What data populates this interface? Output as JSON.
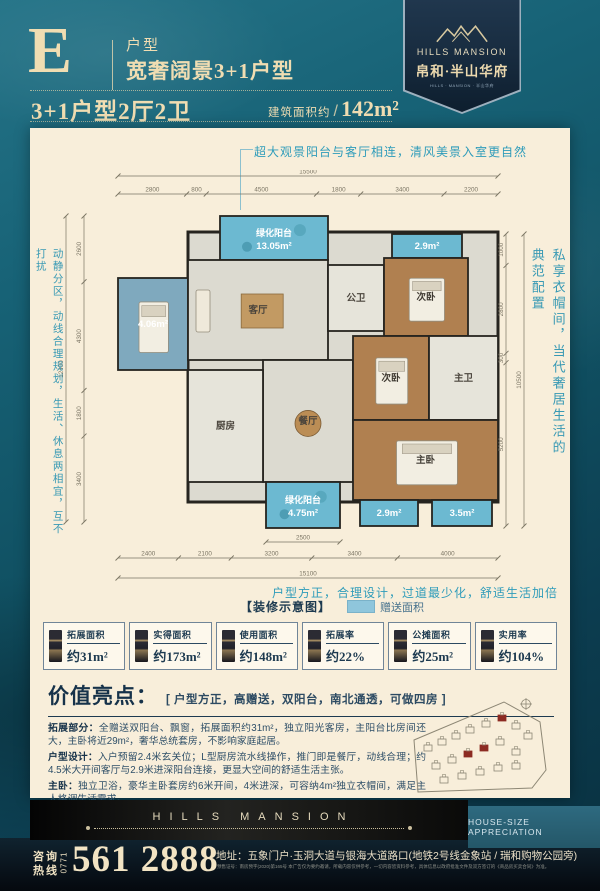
{
  "header": {
    "type_letter": "E",
    "type_label": "户型",
    "type_title": "宽奢阔景3+1户型",
    "spec": "3+1户型2厅2卫",
    "area_label": "建筑面积约",
    "area_divider": "/",
    "area_value": "142m²"
  },
  "logo": {
    "brand_en": "HILLS MANSION",
    "brand_cn": "帛和·半山华府",
    "tagline": "HILLS · MANSION · 半山华府"
  },
  "floorplan": {
    "annotation_top": "超大观景阳台与客厅相连，清风美景入室更自然",
    "annotation_bottom": "户型方正，合理设计，过道最少化，舒适生活加倍",
    "side_note_left": "动静分区，动线合理规划，生活、休息两相宜，互不打扰",
    "side_note_right": "私享衣帽间，当代奢居生活的典范配置",
    "legend_label": "【装修示意图】",
    "legend_gift": "赠送面积",
    "dims": {
      "top_total": "15500",
      "top_segments": [
        "2800",
        "800",
        "4500",
        "1800",
        "3400",
        "2200"
      ],
      "bottom_total": "15100",
      "bottom_segments": [
        "2400",
        "2100",
        "3200",
        "3400",
        "4000"
      ],
      "bottom_inner": "2500",
      "left_total": "12400",
      "left_segments": [
        "2600",
        "4300",
        "1800",
        "3400"
      ],
      "right_total": "10500",
      "right_segments": [
        "1000",
        "2800",
        "300",
        "5200"
      ]
    },
    "rooms": [
      {
        "name": "balcony-top",
        "label": "绿化阳台",
        "area": "13.05m²",
        "x": 172,
        "y": 46,
        "w": 108,
        "h": 44,
        "fill": "#6cb9d1",
        "tc": "#ffffff",
        "deco": "plants"
      },
      {
        "name": "flex-room",
        "area": "4.06m²",
        "x": 70,
        "y": 108,
        "w": 70,
        "h": 92,
        "fill": "#7fa9be",
        "tc": "#ffffff",
        "furn": "bed"
      },
      {
        "name": "living-room",
        "label": "客厅",
        "x": 140,
        "y": 90,
        "w": 140,
        "h": 100,
        "fill": "#dcdad0",
        "tc": "#4a443c",
        "furn": "sofa"
      },
      {
        "name": "bath-public",
        "label": "公卫",
        "x": 280,
        "y": 95,
        "w": 56,
        "h": 66,
        "fill": "#e6e4da",
        "tc": "#4a443c"
      },
      {
        "name": "balcony-ne",
        "area": "2.9m²",
        "x": 344,
        "y": 64,
        "w": 70,
        "h": 24,
        "fill": "#6cb9d1",
        "tc": "#ffffff"
      },
      {
        "name": "bedroom-ne",
        "label": "次卧",
        "x": 336,
        "y": 88,
        "w": 84,
        "h": 78,
        "fill": "#b08050",
        "tc": "#3f3a32",
        "furn": "bed"
      },
      {
        "name": "dining-room",
        "label": "餐厅",
        "x": 215,
        "y": 190,
        "w": 90,
        "h": 122,
        "fill": "#dcdad0",
        "tc": "#4a443c",
        "furn": "table"
      },
      {
        "name": "kitchen",
        "label": "厨房",
        "x": 140,
        "y": 200,
        "w": 75,
        "h": 112,
        "fill": "#e6e4da",
        "tc": "#4a443c"
      },
      {
        "name": "bedroom-mid",
        "label": "次卧",
        "x": 305,
        "y": 166,
        "w": 76,
        "h": 84,
        "fill": "#b08050",
        "tc": "#3f3a32",
        "furn": "bed"
      },
      {
        "name": "bath-master",
        "label": "主卫",
        "x": 381,
        "y": 166,
        "w": 69,
        "h": 84,
        "fill": "#e6e4da",
        "tc": "#4a443c"
      },
      {
        "name": "bedroom-master",
        "label": "主卧",
        "x": 305,
        "y": 250,
        "w": 145,
        "h": 80,
        "fill": "#b08050",
        "tc": "#3f3a32",
        "furn": "bed"
      },
      {
        "name": "balcony-s",
        "label": "绿化阳台",
        "area": "4.75m²",
        "x": 218,
        "y": 312,
        "w": 74,
        "h": 46,
        "fill": "#6cb9d1",
        "tc": "#ffffff",
        "deco": "plants"
      },
      {
        "name": "balcony-s2",
        "area": "2.9m²",
        "x": 312,
        "y": 330,
        "w": 58,
        "h": 26,
        "fill": "#6cb9d1",
        "tc": "#ffffff"
      },
      {
        "name": "balcony-se",
        "area": "3.5m²",
        "x": 384,
        "y": 330,
        "w": 60,
        "h": 26,
        "fill": "#6cb9d1",
        "tc": "#ffffff"
      }
    ]
  },
  "stats": {
    "items": [
      {
        "label": "拓展面积",
        "value": "约31m²"
      },
      {
        "label": "实得面积",
        "value": "约173m²"
      },
      {
        "label": "使用面积",
        "value": "约148m²"
      },
      {
        "label": "拓展率",
        "value": "约22%"
      },
      {
        "label": "公摊面积",
        "value": "约25m²"
      },
      {
        "label": "实用率",
        "value": "约104%"
      }
    ]
  },
  "highlights": {
    "title": "价值亮点：",
    "bracket": "[ 户型方正，高赠送，双阳台，南北通透，可做四房 ]",
    "paragraphs": [
      {
        "lead": "拓展部分：",
        "text": "全赠送双阳台、飘窗，拓展面积约31m²，独立阳光客房，主阳台比房间还大，主卧将近29m²，奢华总统套房，不影响家庭起居。"
      },
      {
        "lead": "户型设计：",
        "text": "入户预留2.4米玄关位；L型厨房流水线操作，推门即是餐厅，动线合理；约4.5米大开间客厅与2.9米进深阳台连接，更显大空间的舒适生活主张。"
      },
      {
        "lead": "主卧：",
        "text": "独立卫浴，豪华主卧套房约6米开间，4米进深，可容纳4m²独立衣帽间，满足主人格调生活需求。"
      }
    ]
  },
  "footer": {
    "brand": "HILLS MANSION",
    "tagline": "HOUSE-SIZE APPRECIATION",
    "hotline_label_1": "咨询",
    "hotline_label_2": "热线",
    "hotline_code": "0771",
    "phone": "561 2888",
    "address": "地址：五象门户·玉洞大道与银海大道路口(地铁2号线金象站 / 瑞和购物公园旁)",
    "disclaimer": "预售证号：南房预字(2020)第165号 本广告仅为要约邀请，所载内容仅供参考，一切内容皆资料参考，具体信息以政府批准文件及双方签订的《商品房买卖合同》为准。"
  },
  "colors": {
    "accent_teal": "#2f9cba",
    "navy": "#1d3a50",
    "cream": "#f0ddb2",
    "gift_area": "#8fc6dc"
  }
}
